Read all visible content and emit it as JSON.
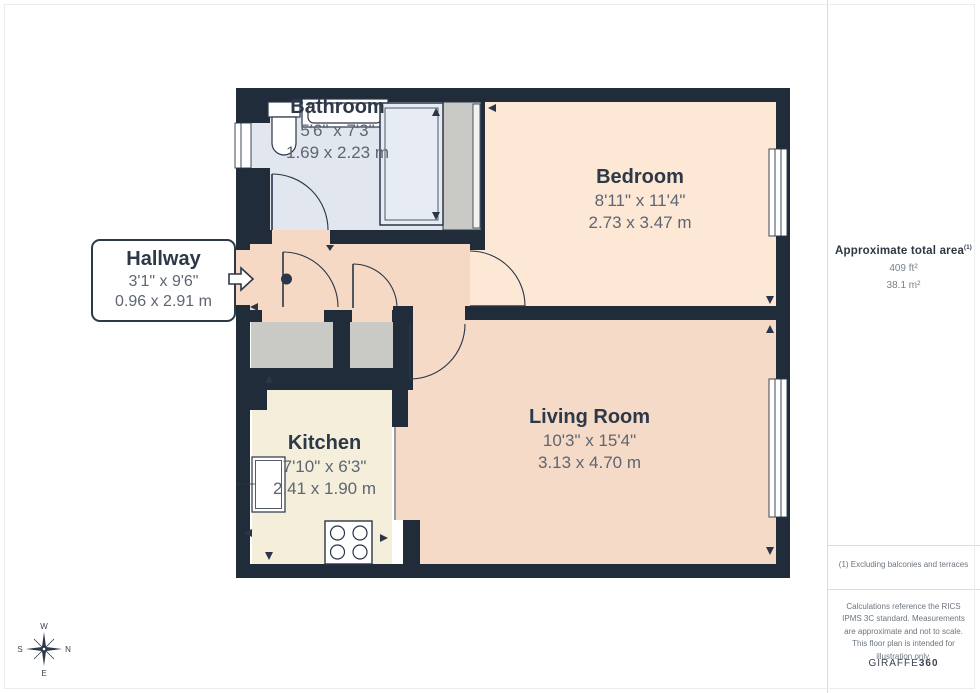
{
  "floorplan": {
    "rooms": [
      {
        "id": "bathroom",
        "name": "Bathroom",
        "dims_imperial": "5'6\" x 7'3\"",
        "dims_metric": "1.69 x 2.23 m"
      },
      {
        "id": "bedroom",
        "name": "Bedroom",
        "dims_imperial": "8'11\" x 11'4\"",
        "dims_metric": "2.73 x 3.47 m"
      },
      {
        "id": "hallway",
        "name": "Hallway",
        "dims_imperial": "3'1\" x 9'6\"",
        "dims_metric": "0.96 x 2.91 m"
      },
      {
        "id": "kitchen",
        "name": "Kitchen",
        "dims_imperial": "7'10\" x 6'3\"",
        "dims_metric": "2.41 x 1.90 m"
      },
      {
        "id": "living_room",
        "name": "Living Room",
        "dims_imperial": "10'3\" x 15'4\"",
        "dims_metric": "3.13 x 4.70 m"
      }
    ],
    "colors": {
      "wall": "#212c3b",
      "line": "#2a3547",
      "bathroom": "#e2e6ee",
      "bedroom": "#fce8d5",
      "hallway": "#f5d9c4",
      "kitchen": "#f4eedb",
      "living_room": "#f5dac8",
      "closet": "#c9c9c5",
      "shower": "#e7ebf3"
    },
    "compass": {
      "top": "W",
      "right": "N",
      "left": "S",
      "bottom": "E"
    }
  },
  "sidebar": {
    "area_title": "Approximate total area",
    "area_title_superscript": "(1)",
    "area_imperial": "409 ft²",
    "area_metric": "38.1 m²",
    "footnote": "(1) Excluding balconies and terraces",
    "disclaimer": "Calculations reference the RICS IPMS 3C standard. Measurements are approximate and not to scale. This floor plan is intended for illustration only.",
    "brand_name": "GIRAFFE",
    "brand_number": "360"
  }
}
